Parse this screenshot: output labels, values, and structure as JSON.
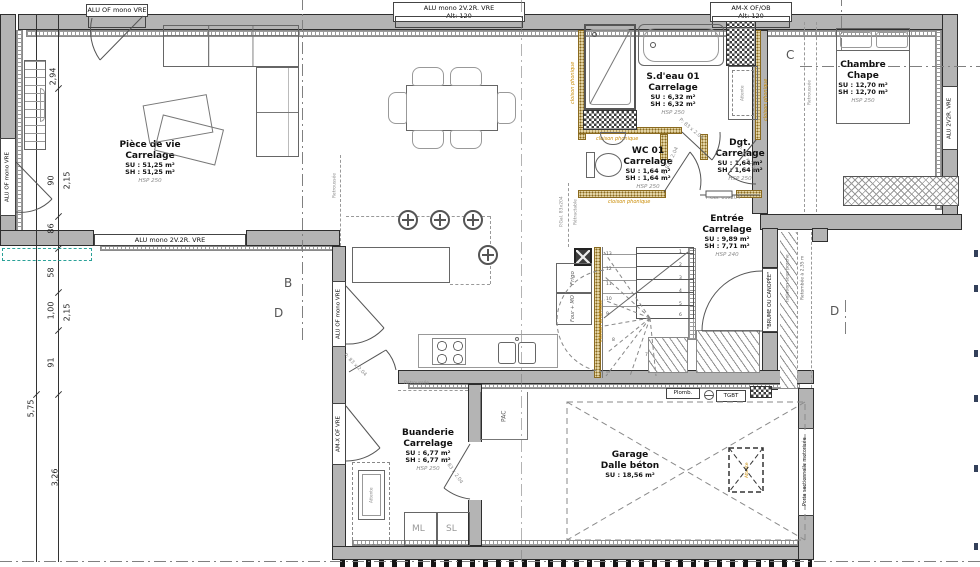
{
  "windows": {
    "top_left": "ALU OF mono VRE",
    "top_mid": "ALU mono 2V.2R. VRE",
    "top_mid_alt": "Alt: 120",
    "top_right": "AM-X OF/OB",
    "top_right_alt": "Alt: 120",
    "left_wall": "ALU OF mono VRE",
    "living_south": "ALU mono 2V.2R. VRE",
    "kitchen_west": "ALU OF mono VRE",
    "laundry_west": "AM-X OF VRE",
    "bedroom_east": "ALU 2V2R. VRE"
  },
  "rooms": {
    "living": {
      "name": "Pièce de vie",
      "floor": "Carrelage",
      "su": "SU : 51,25 m²",
      "sh": "SH : 51,25 m²",
      "hsp": "HSP 250"
    },
    "bath": {
      "name": "S.d'eau 01",
      "floor": "Carrelage",
      "su": "SU : 6,32 m²",
      "sh": "SH : 6,32 m²",
      "hsp": "HSP 250"
    },
    "wc": {
      "name": "WC 01",
      "floor": "Carrelage",
      "su": "SU : 1,64 m²",
      "sh": "SH : 1,64 m²",
      "hsp": "HSP 250"
    },
    "dgt": {
      "name": "Dgt.",
      "floor": "Carrelage",
      "su": "SU : 1,64 m²",
      "sh": "SH : 1,64 m²",
      "hsp": "HSP 250"
    },
    "bedroom": {
      "name": "Chambre",
      "floor": "Chape",
      "su": "SU : 12,70 m²",
      "sh": "SH : 12,70 m²",
      "hsp": "HSP 250"
    },
    "entry": {
      "name": "Entrée",
      "floor": "Carrelage",
      "su": "SU : 9,89 m²",
      "sh": "SH : 7,71 m²",
      "hsp": "HSP 240"
    },
    "laundry": {
      "name": "Buanderie",
      "floor": "Carrelage",
      "su": "SU : 6,77 m²",
      "sh": "SH : 6,77 m²",
      "hsp": "HSP 250"
    },
    "garage": {
      "name": "Garage",
      "floor": "Dalle béton",
      "su": "SU : 18,56 m²"
    }
  },
  "annotations": {
    "cloison": "cloison phonique",
    "door_83": "P: 83 x 2.04",
    "pgal": "P.Gal. 83x204",
    "retractable": "Rétractable",
    "retroussee": "Retroussée",
    "retombee": "Retombée à 2,35 m",
    "isolation": "Isolation sous porche",
    "brume": "\"BRUME OU CANOPÉE\"",
    "porte_sect": "Porte sectionnelle motorisée",
    "attente": "Attente"
  },
  "equipment": {
    "frigo": "Frigo",
    "four": "Four + MO",
    "pac": "PAC",
    "ml": "ML",
    "sl": "SL",
    "plomb": "Plomb.",
    "tgbt": "TGBT"
  },
  "sections": {
    "b": "B",
    "c": "C",
    "d_left": "D",
    "d_right": "D"
  },
  "dimensions": {
    "outer": "5,75",
    "chain": [
      "2,94",
      "90",
      "86",
      "58",
      "1,00",
      "91",
      "3,26"
    ],
    "chain2": [
      "2,15",
      "2,15"
    ]
  },
  "stairs": {
    "r": [
      "1",
      "2",
      "3",
      "4",
      "5",
      "6"
    ],
    "l": [
      "8",
      "9",
      "10",
      "11",
      "12",
      "13"
    ],
    "m": "7"
  }
}
